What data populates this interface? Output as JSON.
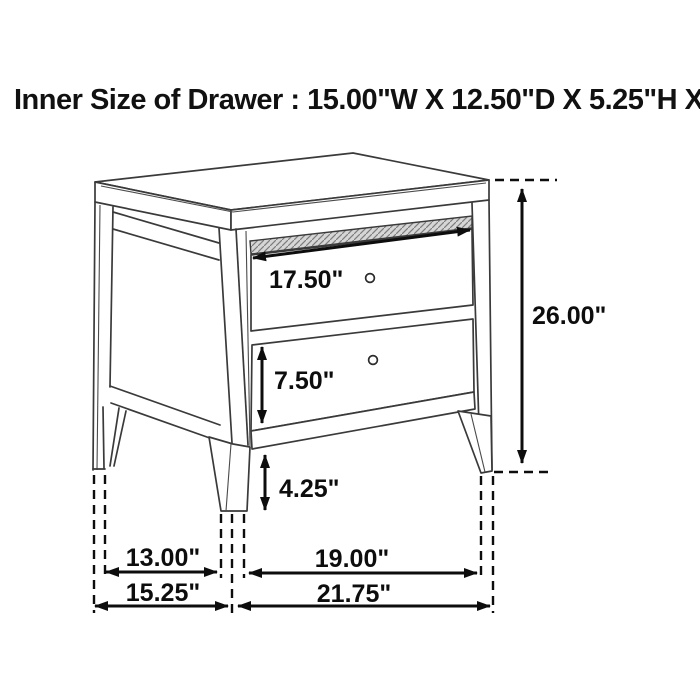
{
  "title": "Inner Size of Drawer : 15.00\"W X 12.50\"D X 5.25\"H X 0.25\"T",
  "dims": {
    "drawer_width": "17.50\"",
    "overall_height": "26.00\"",
    "bottom_drawer_height": "7.50\"",
    "leg_height": "4.25\"",
    "side_leg_span": "13.00\"",
    "front_leg_span": "19.00\"",
    "overall_depth": "15.25\"",
    "overall_width": "21.75\""
  },
  "colors": {
    "background": "#ffffff",
    "furniture_line": "#3a3a3a",
    "dimension_line": "#0d0d0d",
    "hatch_fill": "#c9c9c9"
  }
}
